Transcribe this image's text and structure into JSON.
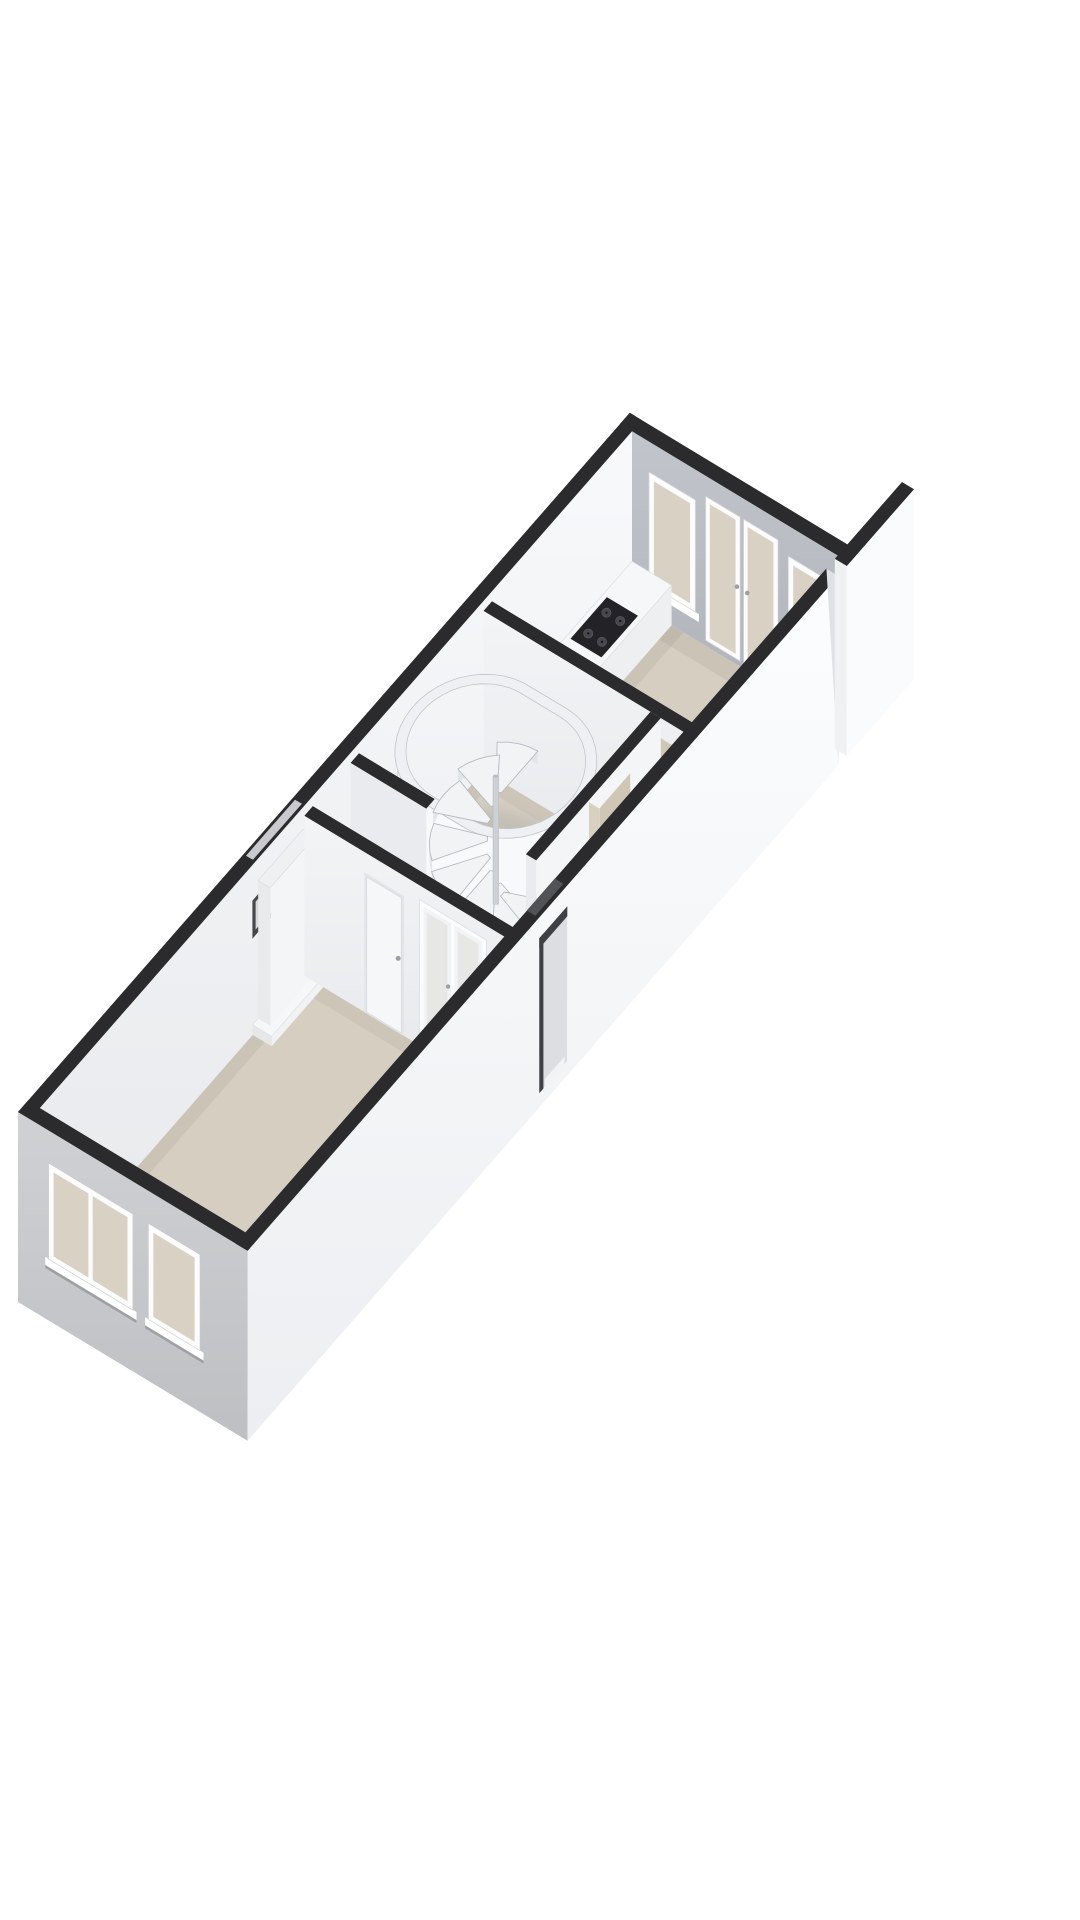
{
  "scene": {
    "type": "3d-floorplan-render",
    "background": "#ffffff",
    "view": "isometric-birdseye",
    "floor_label": ""
  },
  "colors": {
    "wall_top": "#2b2b2d",
    "wall_inner_light": "#f4f5f7",
    "wall_inner_shaded": "#e9ebee",
    "backwall_gray": "#b9bdc3",
    "facade_gray": "#c7c8cb",
    "right_wall_white": "#fafbfd",
    "floor_beige": "#d6cec0",
    "floor_beige_dark": "#cfc6b6",
    "floor_gray": "#d8d9db",
    "glass_beige": "#d9d1c3",
    "frame_white": "#fcfcfd",
    "sill_white": "#ffffff",
    "counter_top": "#f6f7f9",
    "counter_front": "#edeff1",
    "counter_end": "#e3e5e8",
    "cooktop_dark": "#232327",
    "burner_gray": "#47474d",
    "sink_rim": "#c9cdd1",
    "sink_inner": "#edefef",
    "sink_stroke": "#9aa1a7",
    "faucet_gray": "#878e94",
    "capsule_floor": "#e9eaec",
    "capsule_ring": "#eff0f3",
    "capsule_face": "#f8f9fb",
    "tread_fill": "#f1f3f5",
    "tread_stroke": "#b6bac0",
    "riser_fill": "#e3e6e9",
    "pole_gray": "#cdd0d4",
    "door_leaf": "#f6f7f9",
    "door_frame": "#e2e4e7",
    "handle_gray": "#9aa0a6",
    "french_frame": "#fbfcfd",
    "french_glass": "#e7e7e5",
    "reveal_beige": "#d8d0c0",
    "recess_face": "#dcdee1",
    "recess_jamb": "#3e4043",
    "recess_band": "#515357",
    "threshold_white": "#f2f3f5",
    "chimney_front": "#e8eaec",
    "chimney_side": "#f4f5f7",
    "chimney_top": "#eff0f2",
    "slot_dark": "#45474a",
    "slot_inner": "#d7d8da",
    "slot_band": "#c9cacd",
    "fragment_end": "#eff1f3"
  },
  "rooms": [
    {
      "id": "living-room",
      "floor": "beige"
    },
    {
      "id": "hallway",
      "floor": "beige"
    },
    {
      "id": "corridor",
      "floor": "beige"
    },
    {
      "id": "kitchen",
      "floor": "beige"
    }
  ],
  "elements": {
    "floor": "floor-slab",
    "back_wall": "back-wall",
    "back_window_left": "backwall-window-left",
    "back_doors": "backwall-french-doors",
    "back_window_right": "backwall-window-right",
    "left_wall": "left-wall",
    "slot": "left-wall-slot-window",
    "chimney": "chimney-breast",
    "counter": "kitchen-counter",
    "cooktop": "cooktop",
    "sink": "kitchen-sink",
    "faucet": "faucet",
    "divider2": "kitchen-divider-wall",
    "kitchen_doorway": "kitchen-doorway",
    "capsule": "staircase-enclosure",
    "stairs": "spiral-staircase",
    "closet": "meter-closet",
    "corridor_wall": "corridor-wall",
    "corridor_doorway": "corridor-doorway",
    "divider1": "living-hall-divider-wall",
    "closet_door": "closet-door",
    "french_doors": "french-glass-doors",
    "facade": "front-facade",
    "facade_window_large": "facade-window-large",
    "facade_window_small": "facade-window-small",
    "right_wall": "right-wall",
    "entrance": "entrance-recess",
    "fragment": "party-wall-fragment"
  }
}
